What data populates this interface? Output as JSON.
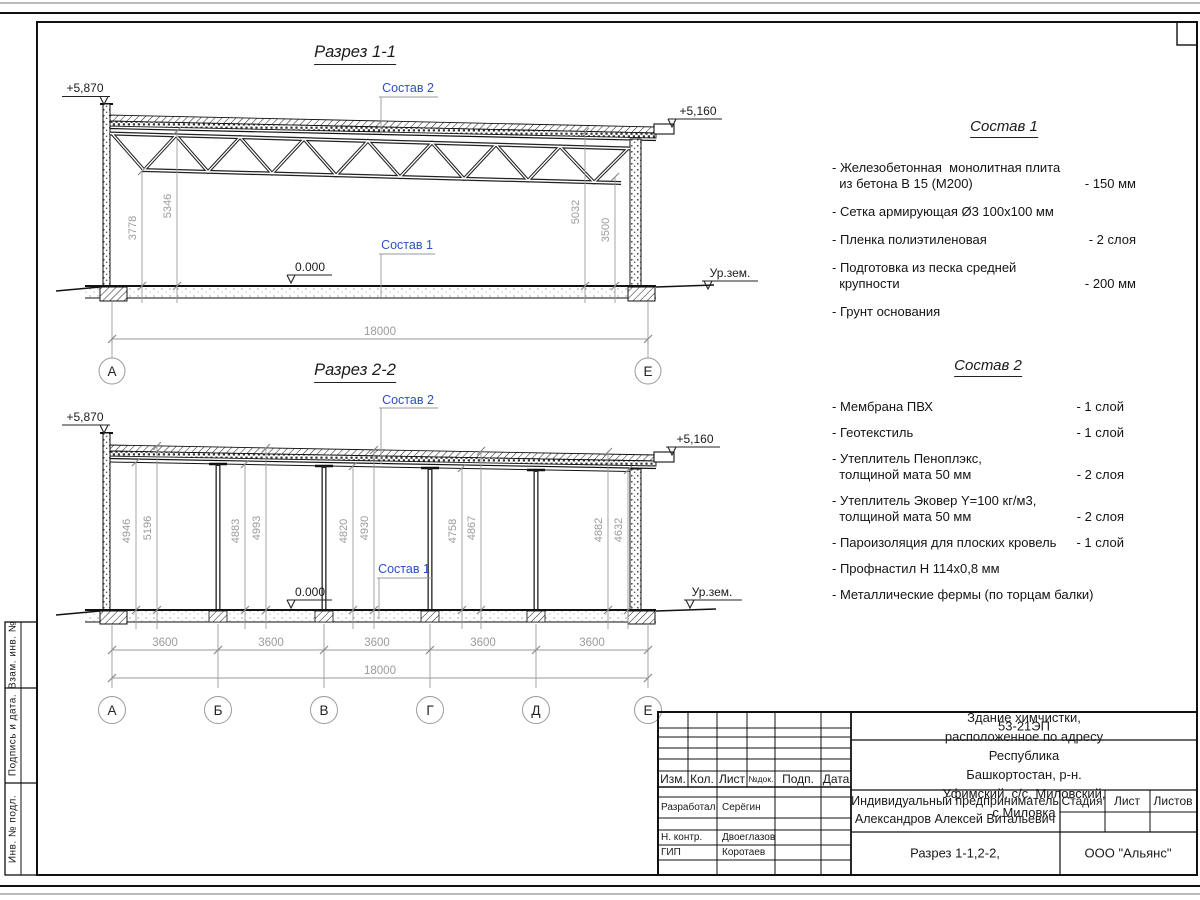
{
  "drawing": {
    "section1": {
      "title": "Разрез 1-1",
      "dim_left_inner": "3778",
      "dim_left_outer": "5346",
      "dim_right_outer": "5032",
      "dim_right_inner": "3500",
      "dim_total": "18000",
      "axis_left": "А",
      "axis_right": "Е"
    },
    "section2": {
      "title": "Разрез 2-2",
      "dim_pairs": [
        [
          "4946",
          "5196"
        ],
        [
          "4883",
          "4993"
        ],
        [
          "4820",
          "4930"
        ],
        [
          "4758",
          "4867"
        ],
        [
          "4882",
          "4632"
        ]
      ],
      "dim_bays": [
        "3600",
        "3600",
        "3600",
        "3600",
        "3600"
      ],
      "dim_total": "18000",
      "axes": [
        "А",
        "Б",
        "В",
        "Г",
        "Д",
        "Е"
      ]
    },
    "marks": {
      "top_left": "+5,870",
      "top_right": "+5,160",
      "zero": "0.000",
      "ground": "Ур.зем."
    },
    "refs": {
      "sostav1": "Состав 1",
      "sostav2": "Состав 2"
    }
  },
  "sostav1": {
    "title": "Состав 1",
    "items": [
      {
        "name": "- Железобетонная  монолитная плита\n  из бетона В 15 (М200)",
        "qty": "- 150 мм"
      },
      {
        "name": "- Сетка армирующая Ø3 100х100 мм",
        "qty": ""
      },
      {
        "name": "- Пленка полиэтиленовая",
        "qty": "-  2 слоя"
      },
      {
        "name": "- Подготовка из песка средней\n  крупности",
        "qty": "- 200 мм"
      },
      {
        "name": "- Грунт основания",
        "qty": ""
      }
    ]
  },
  "sostav2": {
    "title": "Состав 2",
    "items": [
      {
        "name": "- Мембрана ПВХ",
        "qty": "- 1 слой"
      },
      {
        "name": "- Геотекстиль",
        "qty": "- 1 слой"
      },
      {
        "name": "- Утеплитель Пеноплэкс,\n  толщиной мата 50 мм",
        "qty": "- 2 слоя"
      },
      {
        "name": "- Утеплитель Эковер Y=100 кг/м3,\n  толщиной мата 50 мм",
        "qty": "- 2 слоя"
      },
      {
        "name": "- Пароизоляция для плоских кровель",
        "qty": "- 1 слой"
      },
      {
        "name": "- Профнастил Н 114х0,8 мм",
        "qty": ""
      },
      {
        "name": "- Металлические фермы (по торцам балки)",
        "qty": ""
      }
    ]
  },
  "titleblock": {
    "doc_number": "53-21ЭП",
    "object_name": "Здание химчистки,  расположенное по адресу Республика\nБашкортостан, р-н. Уфимский, с/с. Миловский, с.Миловка",
    "columns": {
      "izm": "Изм.",
      "kol": "Кол.",
      "list": "Лист",
      "ndok": "№док.",
      "podp": "Подп.",
      "data": "Дата"
    },
    "roles": [
      {
        "role": "Разработал",
        "name": "Серёгин"
      },
      {
        "role": "Н. контр.",
        "name": "Двоеглазов"
      },
      {
        "role": "ГИП",
        "name": "Коротаев"
      }
    ],
    "client": "Индивидуальный предприниматель\nАлександров Алексей Витальевич",
    "stage": "Стадия",
    "sheet": "Лист",
    "sheets": "Листов",
    "sheet_title": "Разрез 1-1,2-2,",
    "company": "ООО \"Альянс\""
  },
  "margin_strip": {
    "cells": [
      "Взам. инв. №",
      "Подпись и дата.",
      "Инв. № подл."
    ]
  },
  "colors": {
    "accent_blue": "#2b50c8",
    "dim_gray": "#9b9b9b"
  }
}
